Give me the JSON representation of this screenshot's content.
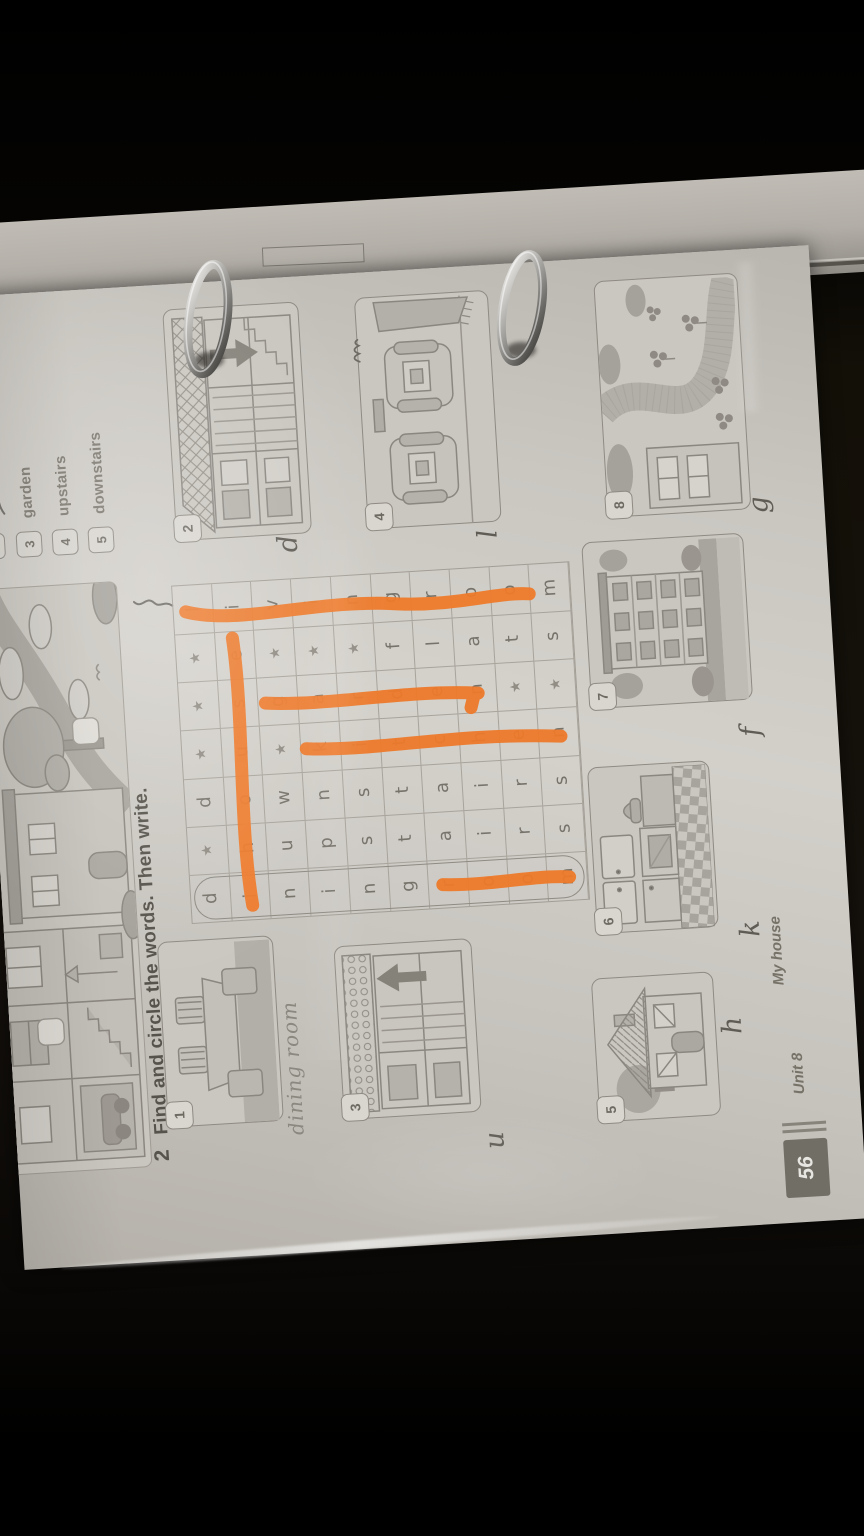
{
  "exercise1": {
    "items": [
      {
        "number": "3",
        "word": "garden"
      },
      {
        "number": "4",
        "word": "upstairs"
      },
      {
        "number": "5",
        "word": "downstairs"
      }
    ]
  },
  "exercise2": {
    "number": "2",
    "instruction": "Find and circle the words. Then write.",
    "wordsearch": {
      "columns": 7,
      "rows": 10,
      "grid_rows": [
        [
          "d",
          "★",
          "d",
          "★",
          "★",
          "★",
          "l"
        ],
        [
          "i",
          "h",
          "o",
          "u",
          "s",
          "e",
          "i"
        ],
        [
          "n",
          "u",
          "w",
          "★",
          "g",
          "★",
          "v"
        ],
        [
          "i",
          "p",
          "n",
          "k",
          "a",
          "★",
          "i"
        ],
        [
          "n",
          "s",
          "s",
          "i",
          "r",
          "★",
          "n"
        ],
        [
          "g",
          "t",
          "t",
          "t",
          "d",
          "f",
          "g"
        ],
        [
          "r",
          "a",
          "a",
          "c",
          "e",
          "l",
          "r"
        ],
        [
          "o",
          "i",
          "i",
          "h",
          "n",
          "a",
          "o"
        ],
        [
          "o",
          "r",
          "r",
          "e",
          "★",
          "t",
          "o"
        ],
        [
          "m",
          "s",
          "s",
          "n",
          "★",
          "s",
          "m"
        ]
      ],
      "hidden_words": [
        {
          "word": "diningroom",
          "direction": "down",
          "col": 1,
          "rows": "1-10",
          "marked": "printed-example-oval-plus-partial-orange"
        },
        {
          "word": "house",
          "direction": "across",
          "row": 2,
          "cols": "2-6",
          "marked": "orange-marker"
        },
        {
          "word": "upstairs",
          "direction": "down",
          "col": 2,
          "rows": "3-10",
          "marked": "none"
        },
        {
          "word": "downstairs",
          "direction": "down",
          "col": 3,
          "rows": "1-10",
          "marked": "none"
        },
        {
          "word": "kitchen",
          "direction": "down",
          "col": 4,
          "rows": "4-10",
          "marked": "orange-marker"
        },
        {
          "word": "garden",
          "direction": "down",
          "col": 5,
          "rows": "3-8",
          "marked": "orange-marker"
        },
        {
          "word": "flats",
          "direction": "down",
          "col": 6,
          "rows": "6-10",
          "marked": "none"
        },
        {
          "word": "livingroom",
          "direction": "down",
          "col": 7,
          "rows": "1-10",
          "marked": "orange-marker"
        }
      ]
    },
    "pictures": [
      {
        "number": "1",
        "answer": "dining room",
        "illustration": "dining-room"
      },
      {
        "number": "2",
        "answer": "d",
        "illustration": "house-cutaway-down-arrow"
      },
      {
        "number": "3",
        "answer": "u",
        "illustration": "house-cutaway-up-arrow"
      },
      {
        "number": "4",
        "answer": "l",
        "illustration": "living-room-armchairs"
      },
      {
        "number": "5",
        "answer": "h",
        "illustration": "house-exterior"
      },
      {
        "number": "6",
        "answer": "k",
        "illustration": "kitchen"
      },
      {
        "number": "7",
        "answer": "f",
        "illustration": "block-of-flats"
      },
      {
        "number": "8",
        "answer": "g",
        "illustration": "garden-path"
      }
    ]
  },
  "footer": {
    "page_number": "56",
    "unit_label": "Unit 8",
    "unit_topic": "My house"
  },
  "colors": {
    "marker_orange": "#ee7a2b",
    "paper": "#c9c6c0",
    "ink_gray": "#76736b",
    "heading_ink": "#55534b",
    "background": "#0b0907",
    "metal_ring": "#b5b4b0"
  }
}
